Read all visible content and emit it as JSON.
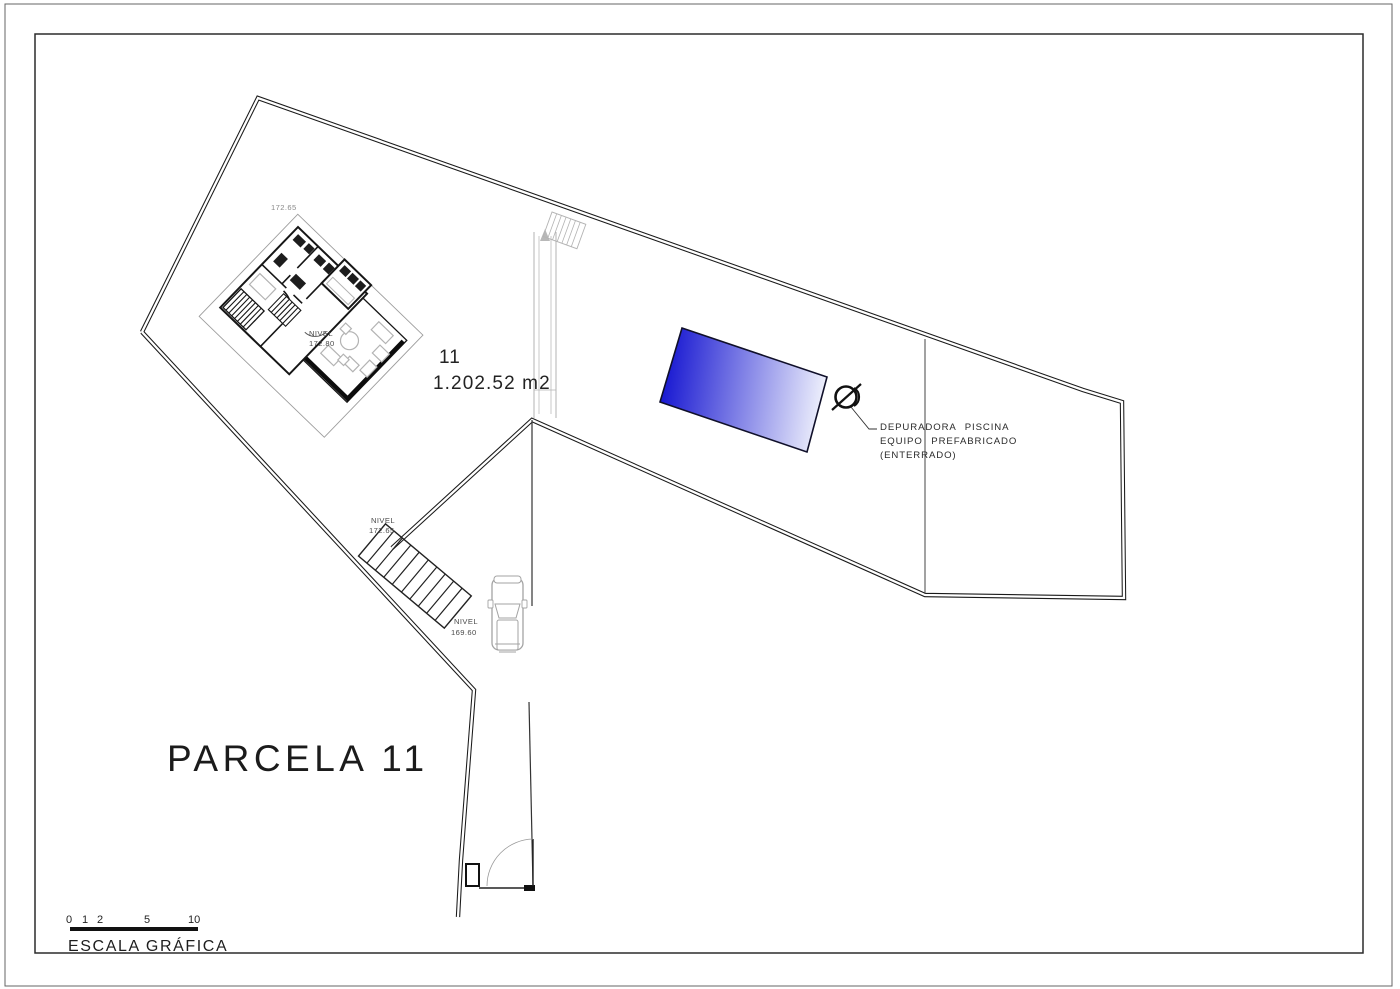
{
  "plot": {
    "number": "11",
    "area": "1.202.52 m2",
    "title": "PARCELA 11"
  },
  "levels": {
    "terrace_spot": "172.65",
    "house_l1": "NIVEL",
    "house_l2": "172.80",
    "upper_l1": "NIVEL",
    "upper_l2": "172.65",
    "drive_l1": "NIVEL",
    "drive_l2": "169.60"
  },
  "pool_note": {
    "l1": "DEPURADORA PISCINA",
    "l2": "EQUIPO PREFABRICADO",
    "l3": "(ENTERRADO)"
  },
  "scale_bar": {
    "tick0": "0",
    "tick1": "1",
    "tick2": "2",
    "tick5": "5",
    "tick10": "10",
    "label": "ESCALA GRÁFICA"
  },
  "colors": {
    "pool_dark": "#1b1bd2",
    "pool_light": "#eef0fc",
    "line": "#1a1a1a",
    "furniture_gray": "#b3b3b3"
  }
}
